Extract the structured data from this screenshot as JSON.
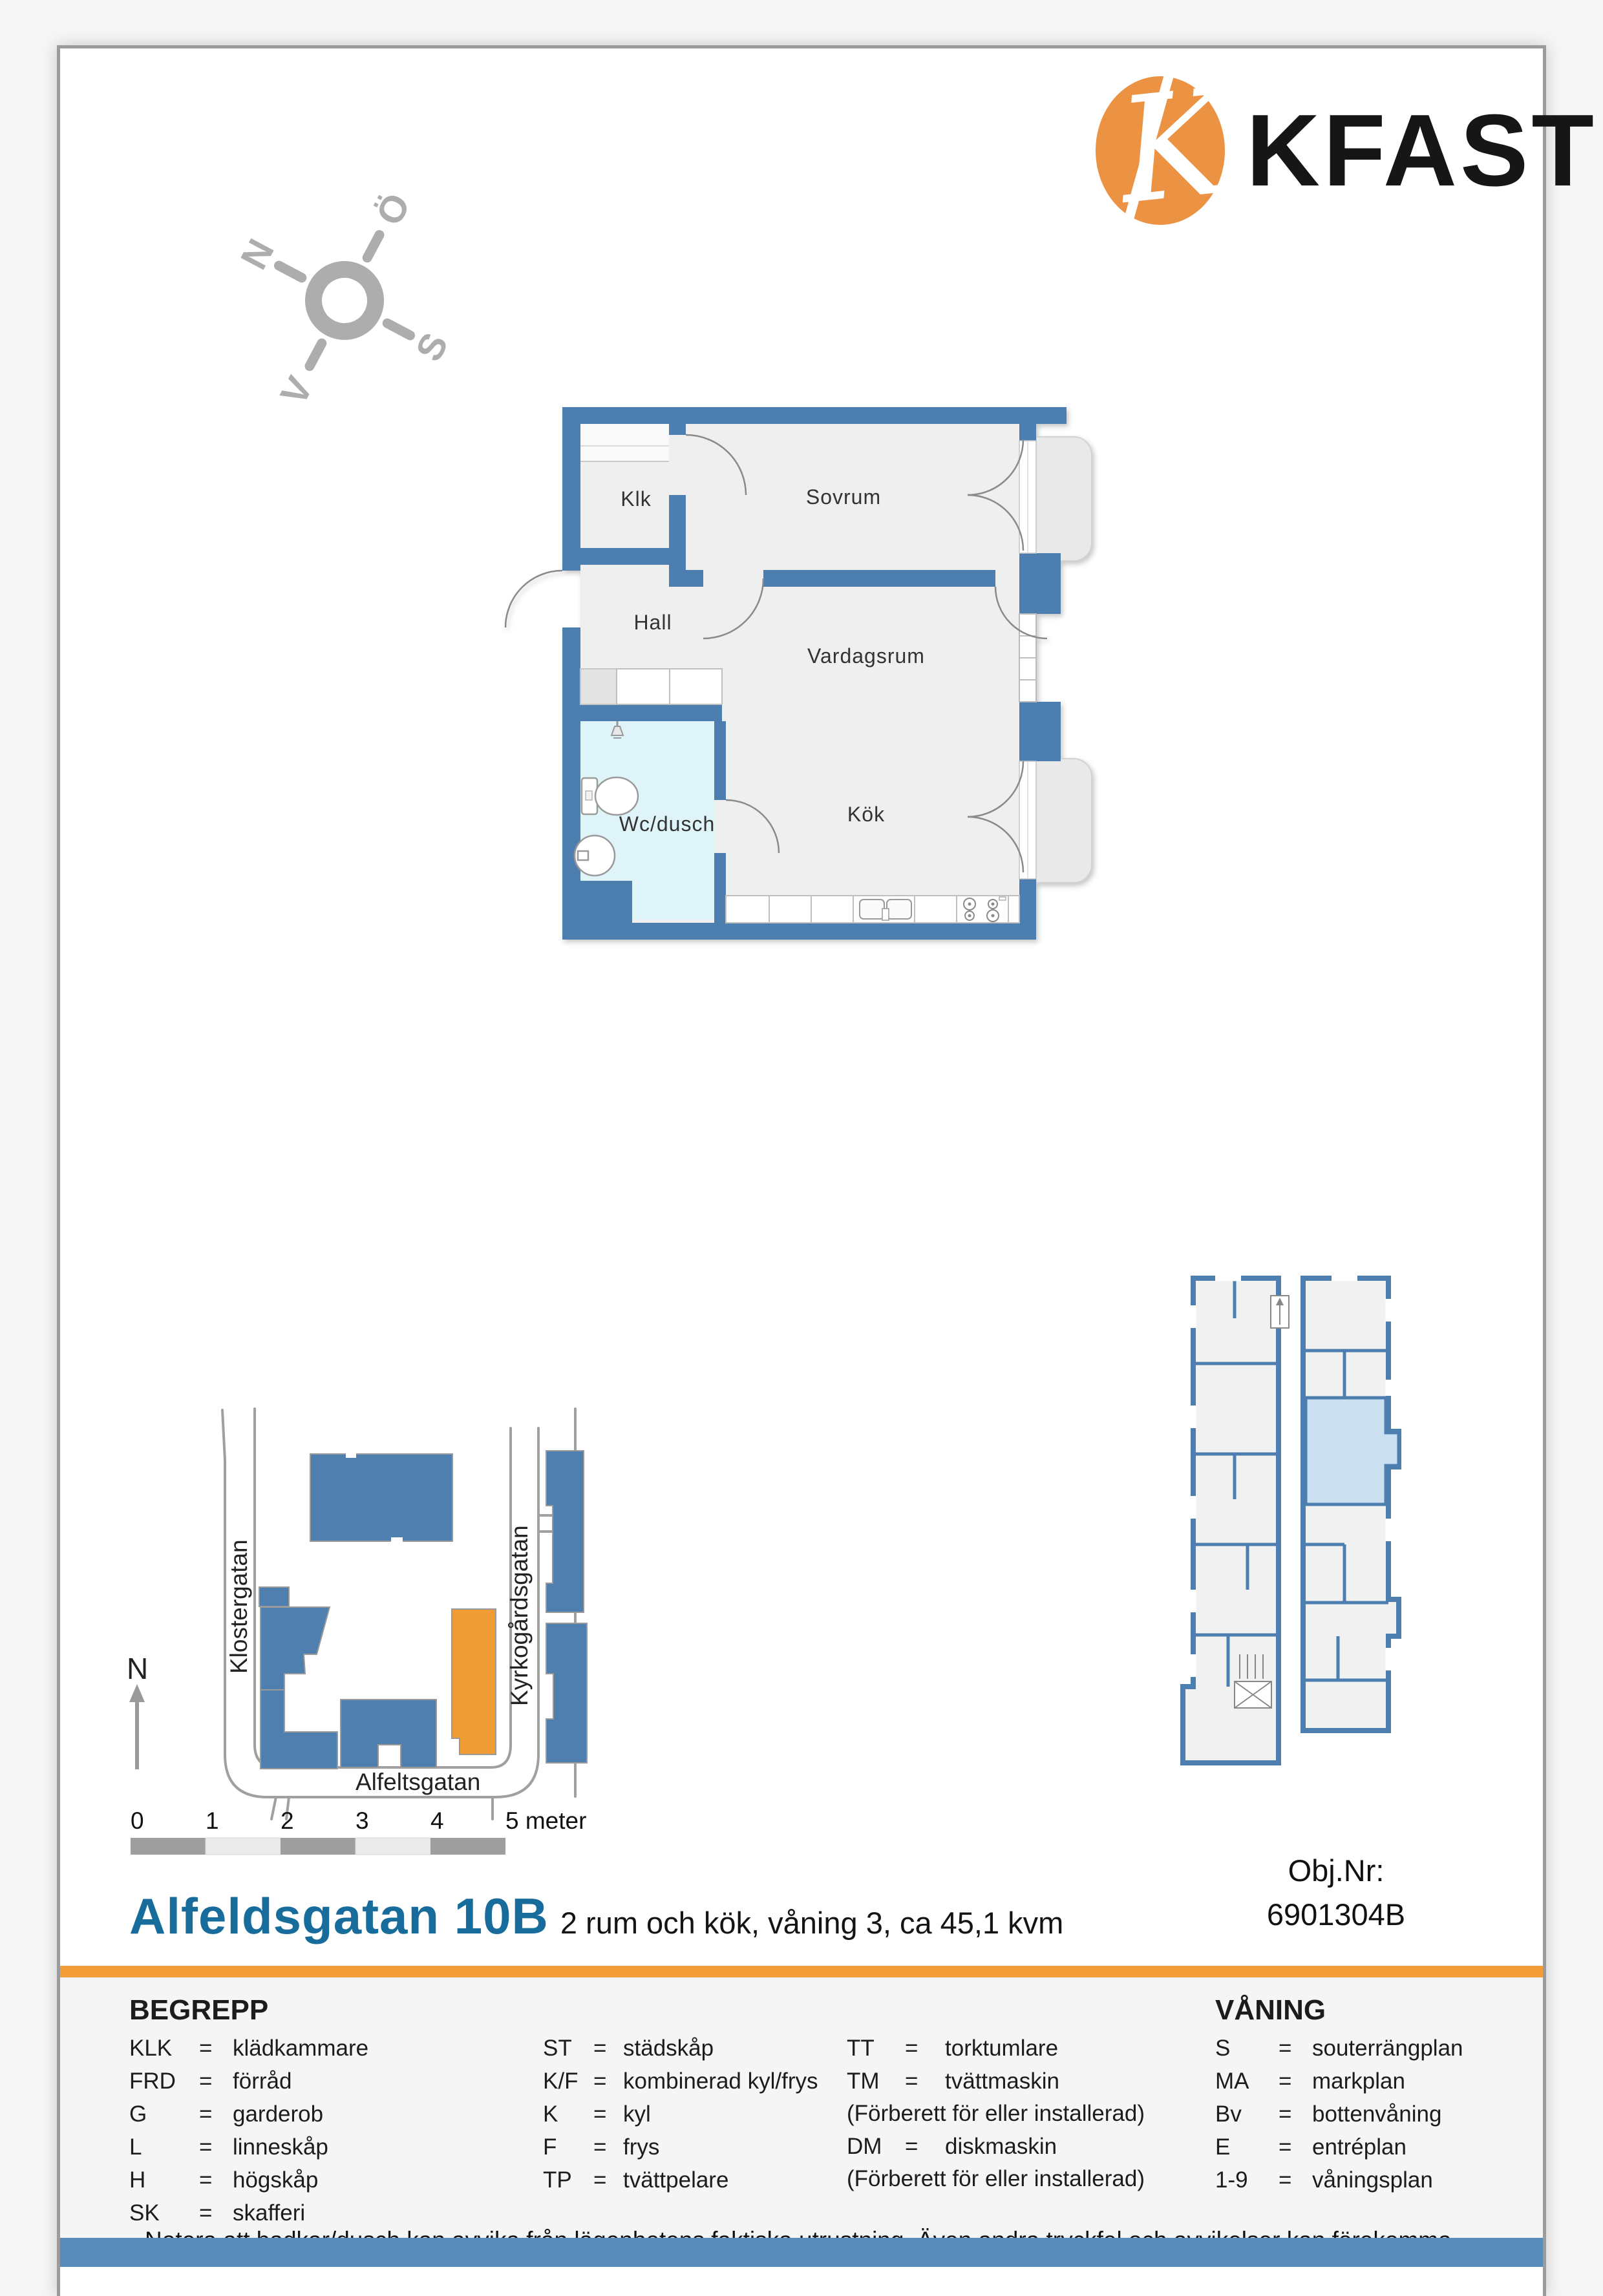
{
  "page": {
    "brand": {
      "logo_letter": "K",
      "name": "KFAST"
    },
    "compass": {
      "n": "N",
      "e": "Ö",
      "s": "S",
      "w": "V"
    },
    "floorplan": {
      "rooms": {
        "klk": "Klk",
        "sovrum": "Sovrum",
        "hall": "Hall",
        "vardagsrum": "Vardagsrum",
        "wc": "Wc/dusch",
        "kok": "Kök"
      }
    },
    "sitemap": {
      "streets": {
        "left": "Klostergatan",
        "right": "Kyrkogårdsgatan",
        "bottom": "Alfeltsgatan"
      },
      "north": "N"
    },
    "scalebar": {
      "ticks": [
        "0",
        "1",
        "2",
        "3",
        "4"
      ],
      "last": "5 meter"
    },
    "title": {
      "address": "Alfeldsgatan 10B",
      "subtitle": "2 rum och kök, våning 3, ca 45,1 kvm"
    },
    "object": {
      "label": "Obj.Nr:",
      "number": "6901304B"
    },
    "legend": {
      "eq": "=",
      "heading": "BEGREPP",
      "col1": [
        {
          "abbr": "KLK",
          "desc": "klädkammare"
        },
        {
          "abbr": "FRD",
          "desc": "förråd"
        },
        {
          "abbr": "G",
          "desc": "garderob"
        },
        {
          "abbr": "L",
          "desc": "linneskåp"
        },
        {
          "abbr": "H",
          "desc": "högskåp"
        },
        {
          "abbr": "SK",
          "desc": "skafferi"
        }
      ],
      "col2": [
        {
          "abbr": "ST",
          "desc": "städskåp"
        },
        {
          "abbr": "K/F",
          "desc": "kombinerad kyl/frys"
        },
        {
          "abbr": "K",
          "desc": "kyl"
        },
        {
          "abbr": "F",
          "desc": "frys"
        },
        {
          "abbr": "TP",
          "desc": "tvättpelare"
        }
      ],
      "col3": [
        {
          "abbr": "TT",
          "desc": "torktumlare"
        },
        {
          "abbr": "TM",
          "desc": "tvättmaskin"
        },
        {
          "abbr": "DM",
          "desc": "diskmaskin"
        }
      ],
      "col3_notes": [
        "(Förberett för eller installerad)",
        "(Förberett för eller installerad)"
      ],
      "vaning_heading": "VÅNING",
      "col4": [
        {
          "abbr": "S",
          "desc": "souterrängplan"
        },
        {
          "abbr": "MA",
          "desc": "markplan"
        },
        {
          "abbr": "Bv",
          "desc": "bottenvåning"
        },
        {
          "abbr": "E",
          "desc": "entréplan"
        },
        {
          "abbr": "1-9",
          "desc": "våningsplan"
        }
      ]
    },
    "note": "Notera att badkar/dusch kan avvika från lägenhetens faktiska utrustning. Även andra tryckfel och avvikelser kan förekomma.",
    "colors": {
      "wall_blue": "#4C7FB0",
      "accent_orange": "#F29D37",
      "highlight_blue": "#CADFF0",
      "title_blue": "#176C9C",
      "footer_bar_blue": "#578BB8",
      "bathroom_floor": "#DFF4F9"
    }
  }
}
